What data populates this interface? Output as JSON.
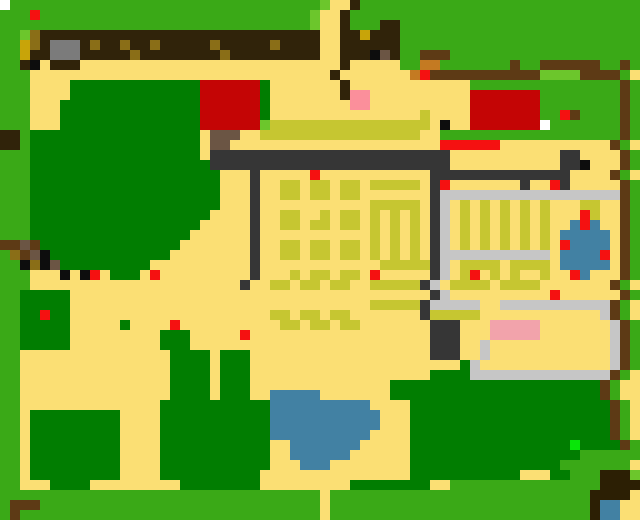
{
  "map": {
    "cols": 64,
    "rows_count": 52,
    "cell": 10,
    "fill": "Y",
    "palette": {
      "G": {
        "name": "grass-green",
        "color": "#3aa917"
      },
      "g": {
        "name": "grass-light",
        "color": "#6cc62c"
      },
      "D": {
        "name": "tree-dark-green",
        "color": "#017d01"
      },
      "Y": {
        "name": "sand-path",
        "color": "#fbdf74"
      },
      "B": {
        "name": "treeline-dark-brown",
        "color": "#30230a"
      },
      "n": {
        "name": "fence-brown",
        "color": "#5d3a15"
      },
      "b": {
        "name": "porch-brown",
        "color": "#6b5544"
      },
      "O": {
        "name": "doghouse-orange",
        "color": "#c47a22"
      },
      "o": {
        "name": "canopy-olive",
        "color": "#8a6e17"
      },
      "A": {
        "name": "fruit-gold",
        "color": "#c8a409"
      },
      "c": {
        "name": "crop-olive",
        "color": "#c6c631"
      },
      "K": {
        "name": "stone-wall-dark",
        "color": "#363636"
      },
      "k": {
        "name": "shed-gray",
        "color": "#7b7b7b"
      },
      "C": {
        "name": "greenhouse-gray",
        "color": "#c6c6c6"
      },
      "R": {
        "name": "roof-red",
        "color": "#c40505"
      },
      "r": {
        "name": "berry-red",
        "color": "#f51111"
      },
      "P": {
        "name": "pink-mat",
        "color": "#fb8f9b"
      },
      "Q": {
        "name": "pink-block",
        "color": "#f2a3ab"
      },
      "L": {
        "name": "pond-blue",
        "color": "#4281a3"
      },
      "W": {
        "name": "white-door",
        "color": "#ffffff"
      },
      "X": {
        "name": "black-pixel",
        "color": "#0d0d0d"
      },
      "N": {
        "name": "dark-chocolate",
        "color": "#2c1f04"
      },
      "E": {
        "name": "neon-green-item",
        "color": "#08e608"
      }
    },
    "rows": [
      "WGGGGGGGGGGGGGGGGGGGGGGGGGGGGGGGgYYBGGGGGGGGGGGGGGGGGGGGGGGGGGGG",
      "GGGrGGGGGGGGGGGGGGGGGGGGGGGGGGGgYYBGGGGGGGGGGGGGGGGGGGGGGGGGGGGG",
      "GGGGGGGGGGGGGGGGGGGGGGGGGGGGGGGgYYBGGGBBGGGGGGGGGGGGGGGGGGGGGGGG",
      "GGgoBBBBBBBBBBBBBBBBBBBBBBBBBBBBYYBBABBBGGGGGGGGGGGGGGGGGGGGGGGG",
      "GGAoBkkkBoBBoBBoBBBBBoBBBBBoBBBBYYBBBBBBGGGGGGGGGGGGGGGGGGGGGGGG",
      "GGABBkkkBBBBBoBBBBBBBBoBBBBBBBBBYYBBBXbBGGnnnGGGGGGGGGGGGGGGGGGG",
      "GGBXYBBBYYYYYYYYYYYYYYYYYYYYYYYYYYBYYYYYGGOOGGGGGGGnGGnnnnnnGGnG",
      "GGGYYYYYYYYYYYYYYYYYYYYYYYYYYYYYYBYYYYYYYOrnnnnnnnnnnnggggnnnnG",
      "GGGYYYYDDDDDDDDDDDDDRRRRRRDYYYYYYYBYYYYYYYYYYYYGGGGGGGGGGGGGGGnG",
      "GGGYYYYDDDDDDDDDDDDDRRRRRRDYYYYYYYBPPYYYYYYYYYYRRRRRRRGGGGGGGGnG",
      "GGGYYYDDDDDDDDDDDDDDRRRRRRDYYYYYYYYPPYYYYYYYYYYRRRRRRRGGGGGGGGnG",
      "GGGYYYDDDDDDDDDDDDDDRRRRRRDYYYYYYYYYYYYYYYcYYYYRRRRRRRGGrnGGGGnG",
      "GGGYYYDDDDDDDDDDDDDDRRRRRRgccccccccccccccccYXYYRRRRRRRWGGGGGGGnG",
      "BBGDDDDDDDDDDDDDDDDDYbbbYYccccccccccccccccYYGGGGGGGGGGGGGGGGGGnG",
      "BBGDDDDDDDDDDDDDDDDDYbbYYYYYYYYYYYYYYYYYYYYYrrrrrrYYYYYYYYYYYnG",
      "GGGDDDDDDDDDDDDDDDDDYKKKKKKKKKKKKKKKKKKKKKKKKYYYYYYYYYYYKKYYYYnG",
      "GGGDDDDDDDDDDDDDDDDDDKKKKKKKKKKKKKKKKKKKKKKKKYYYYYYYYYYYKKXYYYnG",
      "GGGDDDDDDDDDDDDDDDDDDDYYYKYYYYYrYYYYYYYYYYYKKKKKKKKKKKKKKYYYYnG",
      "GGGDDDDDDDDDDDDDDDDDDDYYYKYYccYccYccYcccccYKrYYYYYYYKYYrKYYYYYnG",
      "GGGDDDDDDDDDDDDDDDDDDDYYYKYYccYccYccYYYYYYYKCCCCCCCCCCCCCCCCCCnG",
      "GGGDDDDDDDDDDDDDDDDDDDYYYKYYYYYYYYYYYcccccYKCYcYcYcYcYcYYYccYYnG",
      "GGGDDDDDDDDDDDDDDDDDDYYYYKYYccYYcYccYcYcYcYKCYcYcYcYcYcYYYrcYYnG",
      "GGGDDDDDDDDDDDDDDDDDYYYYYKYYccYccYccYcYcYcYKCYcYcYcYcYcYYLrLYYnG",
      "GGGDDDDDDDDDDDDDDDDYYYYYYKYYYYYYYYYYYcYcYcYKCYcYcYcYcYcYLLLLLYnG",
      "nnbnDDDDDDDDDDDDDDYYYYYYYKYYccYccYccYcYcYcYKCYcYcYcYcYcYrLLLLYnG",
      "GonbXDDDDDDDDDDDDYYYYYYYYKYYccYccYccYcYcYcYKCCCCCCCCCCCYLLLLrYnG",
      "GGXoXbDDDDDDDDDYYYYYYYYYYKYYYYYYYYYYYYcccccKCYccccYccccYLLLLLYnG",
      "GGGYYYXYXrYDDDYrYYYYYYYYYKYYYcYccYccYrYYYYYKCYcrYcYcYYcYYrLYYYnG",
      "GGGYYYYYYYYYYYYYYYYYYYYYKYYccYccYccYYcccccKCYccccYccccYYYYYYYnG",
      "GGDDDDDYYYYYYYYYYYYYYYYYYYYYYYYYYYYYYYYYYYYKCYYYYYYYYYYrYYYYYYnG",
      "GGDDDDDYYYYYYYYYYYYYYYYYYYYYYYYYYYYYYcccccKCCCCCYYCCCCCCCCCCCnG",
      "GGDDrDDYYYYYYYYYYYYYYYYYYYYccYccYccYYYYYYYKcccccYYYYYYYYYYYYCnG",
      "GGDDDDDYYYYYDYYYYrYYYYYYYYYYccYccYccYYYYYYYKKKYYYQQQQQYYYYYYYCnG",
      "GGDDDDDYYYYYYYYYDDDYYYYYrYYYYYYYYYYYYYYYYYYKKKYYYQQQQQYYYYYYYCnG",
      "GGDDDDDYYYYYYYYYDDDYYYYYYYYYYYYYYYYYYYYYYYYKKKYYCYYYYYYYYYYYYCnG",
      "GGYYYYYYYYYYYYYYYDDDDYDDDYYYYYYYYYYYYYYYYYYKKKYYCYYYYYYYYYYYYCnG",
      "GGYYYYYYYYYYYYYYYDDDDYDDDYYYYYYYYYYYYYYYYYYYYYDCYYYYYYYYYYYYYCnG",
      "GGYYYYYYYYYYYYYYYDDDDYDDDYYYYYYYYYYYYYYYYYYDDDDCCCCCCCCCCCCCCnG",
      "GGYYYYYYYYYYYYYYYDDDDYDDDYYYYYYYYYYYYYYDDDDDDDDDDDDDDDDDDDDDnG",
      "GGYYYYYYYYYYYYYYYDDDDYDDDYYLLLLLYYYYYYYDDDDDDDDDDDDDDDDDDDDDnG",
      "GGYYYYYYYYYYYYYYDDDDDDDDDDDLLLLLLLLLLYYYYDDDDDDDDDDDDDDDDDDDDnG",
      "GGYDDDDDDDDDYYYYDDDDDDDDDDDLLLLLLLLLLLYYYDDDDDDDDDDDDDDDDDDDDnG",
      "GGYDDDDDDDDDYYYYDDDDDDDDDDDLLLLLLLLLLLYYYDDDDDDDDDDDDDDDDDDDDnG",
      "GGYDDDDDDDDDYYYYDDDDDDDDDDDLLLLLLLLLLYYYYDDDDDDDDDDDDDDDDDDDDnG",
      "GGYDDDDDDDDDYYYYDDDDDDDDDDDYYLLLLLLLYYYYYDDDDDDDDDDDDDDDDEDDDDnG",
      "GGYDDDDDDDDDYYYYDDDDDDDDDDDYYLLLLLLYYYYYYDDDDDDDDDDDDDDDDDGGGGGG",
      "GGYDDDDDDDDDYYYYDDDDDDDDDDDYYYLLLYYYYYYYYDDDDDDDDDDDDDDDGGGGGGG",
      "GGYDDDDDDDDDYYYYDDDDDDDDDDYYYYYYYYYYYYYYYDDDDDDDDDDDYYYDDGGGNNNg",
      "GGYYYDDDDYYYYYYYYYDDDDDDDDYYYYYYYYYDDDDDDDDYYGGGGGGGGGGGGGGGNNNN",
      "GGGGGGGGGGGGGGGGGGGGGGGGGGGGGGGGYGGGGGGGGGGGGGGGGGGGGGGGGGGNNNN",
      "GnnnGGGGGGGGGGGGGGGGGGGGGGGGGGGGYGGGGGGGGGGGGGGGGGGGGGGGGGGNLLY",
      "GnGGGGGGGGGGGGGGGGGGGGGGGGGGGGGGYGGGGGGGGGGGGGGGGGGGGGGGGGGNLLY",
      "GnGGGGGGGGGGGGGGGGGGGGGGGGGGGGGGYGGGGGGGGGGGGGGGGGGGGGGGGGGNLLY"
    ],
    "features": [
      {
        "name": "farmhouse-red-roof",
        "col": 20,
        "row": 8,
        "w": 6,
        "h": 5
      },
      {
        "name": "farmhouse-porch",
        "col": 21,
        "row": 13,
        "w": 3,
        "h": 1
      },
      {
        "name": "gray-shed",
        "col": 5,
        "row": 4,
        "w": 3,
        "h": 2
      },
      {
        "name": "barn-red-roof",
        "col": 47,
        "row": 9,
        "w": 7,
        "h": 4
      },
      {
        "name": "barn-white-door",
        "col": 54,
        "row": 12,
        "w": 1,
        "h": 1
      },
      {
        "name": "animal-pen",
        "col": 54,
        "row": 6,
        "w": 6,
        "h": 2
      },
      {
        "name": "doghouse-orange",
        "col": 42,
        "row": 6,
        "w": 2,
        "h": 2
      },
      {
        "name": "pink-mat",
        "col": 35,
        "row": 9,
        "w": 2,
        "h": 2
      },
      {
        "name": "crop-field",
        "col": 26,
        "row": 17,
        "w": 17,
        "h": 16
      },
      {
        "name": "stone-wall",
        "col": 21,
        "row": 15,
        "w": 24,
        "h": 2
      },
      {
        "name": "greenhouse",
        "col": 44,
        "row": 19,
        "w": 18,
        "h": 12
      },
      {
        "name": "garden-boxes",
        "col": 46,
        "row": 26,
        "w": 9,
        "h": 3
      },
      {
        "name": "small-pond",
        "col": 56,
        "row": 22,
        "w": 5,
        "h": 6
      },
      {
        "name": "pink-block-shipping",
        "col": 49,
        "row": 32,
        "w": 5,
        "h": 2
      },
      {
        "name": "big-pond",
        "col": 27,
        "row": 39,
        "w": 11,
        "h": 8
      },
      {
        "name": "north-treeline",
        "col": 4,
        "row": 3,
        "w": 36,
        "h": 3
      },
      {
        "name": "west-forest",
        "col": 3,
        "row": 8,
        "w": 19,
        "h": 19
      },
      {
        "name": "south-east-forest",
        "col": 41,
        "row": 38,
        "w": 21,
        "h": 9
      },
      {
        "name": "top-right-fence",
        "col": 44,
        "row": 5,
        "w": 19,
        "h": 3
      },
      {
        "name": "bottom-right-water",
        "col": 60,
        "row": 47,
        "w": 4,
        "h": 5
      },
      {
        "name": "south-path-exit",
        "col": 32,
        "row": 49,
        "w": 1,
        "h": 3
      },
      {
        "name": "north-path-exit",
        "col": 32,
        "row": 0,
        "w": 2,
        "h": 7
      }
    ]
  }
}
